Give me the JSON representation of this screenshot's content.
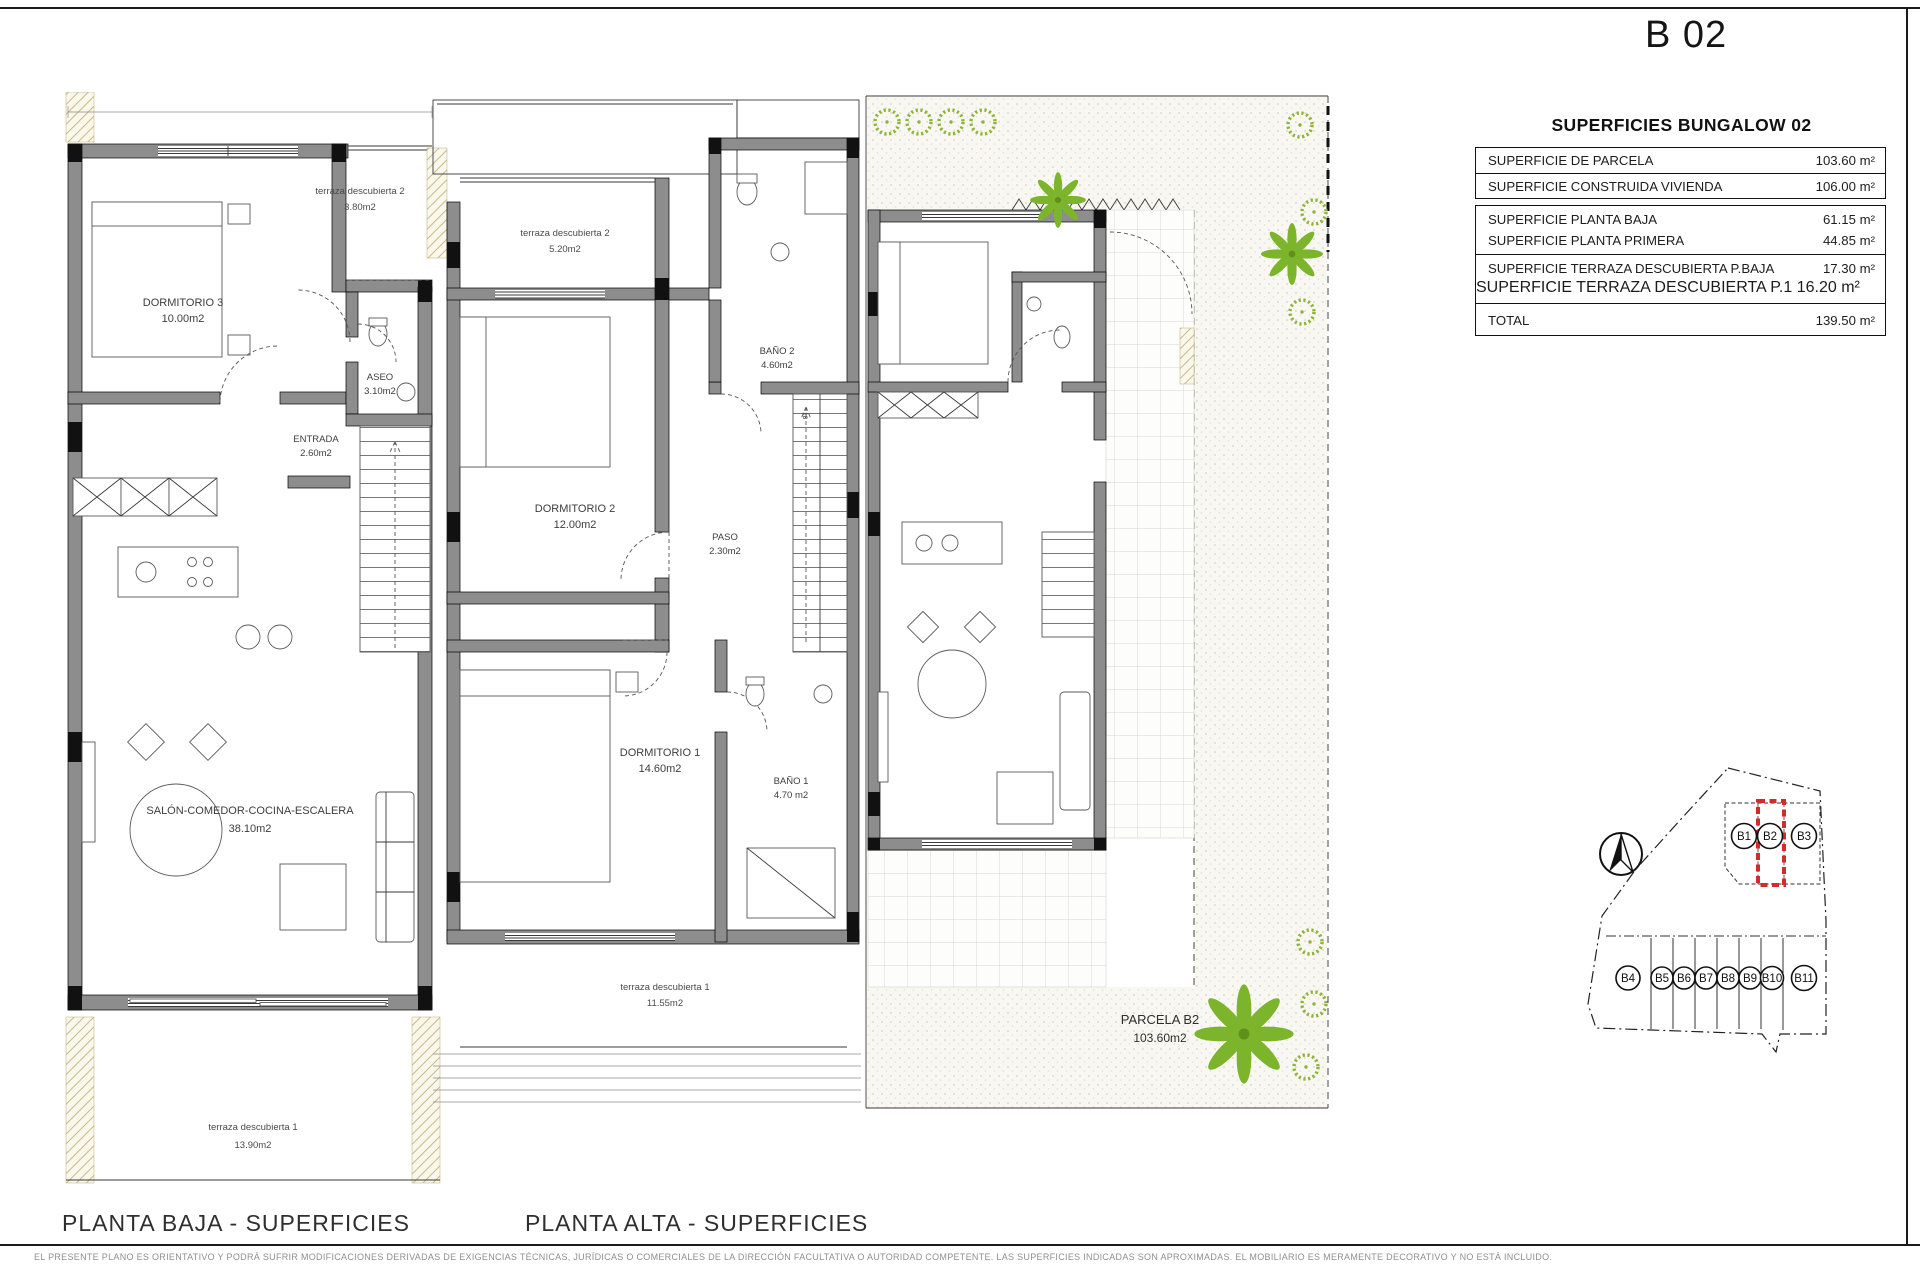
{
  "header": {
    "plan_code": "B 02"
  },
  "surfaces_table": {
    "title": "SUPERFICIES BUNGALOW 02",
    "rows_box1": [
      {
        "label": "SUPERFICIE DE PARCELA",
        "value": "103.60 m²"
      },
      {
        "label": "SUPERFICIE CONSTRUIDA VIVIENDA",
        "value": "106.00 m²"
      }
    ],
    "rows_box2": [
      {
        "label": "SUPERFICIE PLANTA BAJA",
        "value": "61.15 m²"
      },
      {
        "label": "SUPERFICIE PLANTA PRIMERA",
        "value": "44.85 m²"
      },
      {
        "label": "SUPERFICIE TERRAZA DESCUBIERTA P.BAJA",
        "value": "17.30 m²"
      },
      {
        "label": "SUPERFICIE TERRAZA DESCUBIERTA P.1",
        "value": "16.20 m²"
      },
      {
        "label": "TOTAL",
        "value": "139.50 m²"
      }
    ]
  },
  "planta_baja": {
    "caption": "PLANTA BAJA - SUPERFICIES",
    "rooms": {
      "dormitorio3": {
        "name": "DORMITORIO 3",
        "area": "10.00m2"
      },
      "terraza2": {
        "name": "terraza descubierta 2",
        "area": "3.80m2"
      },
      "aseo": {
        "name": "ASEO",
        "area": "3.10m2"
      },
      "entrada": {
        "name": "ENTRADA",
        "area": "2.60m2"
      },
      "salon": {
        "name": "SALÓN-COMEDOR-COCINA-ESCALERA",
        "area": "38.10m2"
      },
      "terraza1": {
        "name": "terraza descubierta 1",
        "area": "13.90m2"
      }
    }
  },
  "planta_alta": {
    "caption": "PLANTA ALTA - SUPERFICIES",
    "rooms": {
      "terraza2": {
        "name": "terraza descubierta 2",
        "area": "5.20m2"
      },
      "dormitorio2": {
        "name": "DORMITORIO 2",
        "area": "12.00m2"
      },
      "bano2": {
        "name": "BAÑO 2",
        "area": "4.60m2"
      },
      "paso": {
        "name": "PASO",
        "area": "2.30m2"
      },
      "dormitorio1": {
        "name": "DORMITORIO 1",
        "area": "14.60m2"
      },
      "bano1": {
        "name": "BAÑO 1",
        "area": "4.70 m2"
      },
      "terraza1": {
        "name": "terraza descubierta 1",
        "area": "11.55m2"
      }
    },
    "stair_top_number": "18"
  },
  "parcela_plan": {
    "label": "PARCELA B2",
    "area": "103.60m2"
  },
  "site_plan": {
    "highlighted_unit": "B2",
    "top_units": [
      "B1",
      "B2",
      "B3"
    ],
    "bottom_units": [
      "B4",
      "B5",
      "B6",
      "B7",
      "B8",
      "B9",
      "B10",
      "B11"
    ],
    "highlight_color": "#d32b2b",
    "plant_color": "#82b532",
    "wall_color": "#8d8d8d"
  },
  "footer": {
    "disclaimer": "EL PRESENTE PLANO ES ORIENTATIVO Y PODRÁ SUFRIR MODIFICACIONES DERIVADAS DE EXIGENCIAS TÉCNICAS, JURÍDICAS O COMERCIALES DE LA DIRECCIÓN FACULTATIVA O AUTORIDAD COMPETENTE. LAS SUPERFICIES INDICADAS SON APROXIMADAS. EL MOBILIARIO ES MERAMENTE DECORATIVO Y NO ESTÁ INCLUIDO."
  }
}
